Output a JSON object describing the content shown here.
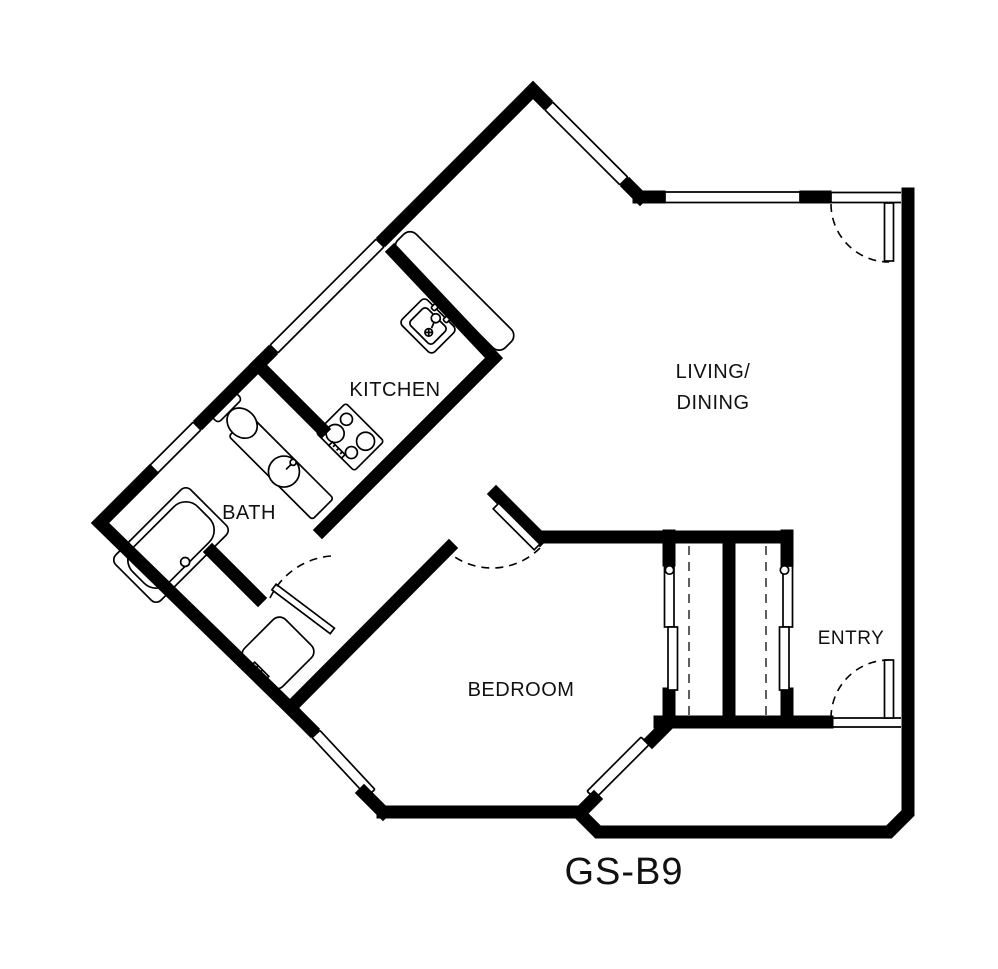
{
  "plan": {
    "code": "GS-B9"
  },
  "rooms": {
    "kitchen": "KITCHEN",
    "bath": "BATH",
    "bedroom": "BEDROOM",
    "entry": "ENTRY",
    "living_line1": "LIVING/",
    "living_line2": "DINING"
  },
  "colors": {
    "wall": "#000000",
    "background": "#ffffff"
  },
  "legend": {
    "icons": [
      "bathtub-icon",
      "toilet-icon",
      "bathroom-sink-icon",
      "kitchen-sink-icon",
      "range-icon",
      "washer-icon",
      "door-swing-arc",
      "window-double-line",
      "closet-rod-dashed"
    ]
  }
}
